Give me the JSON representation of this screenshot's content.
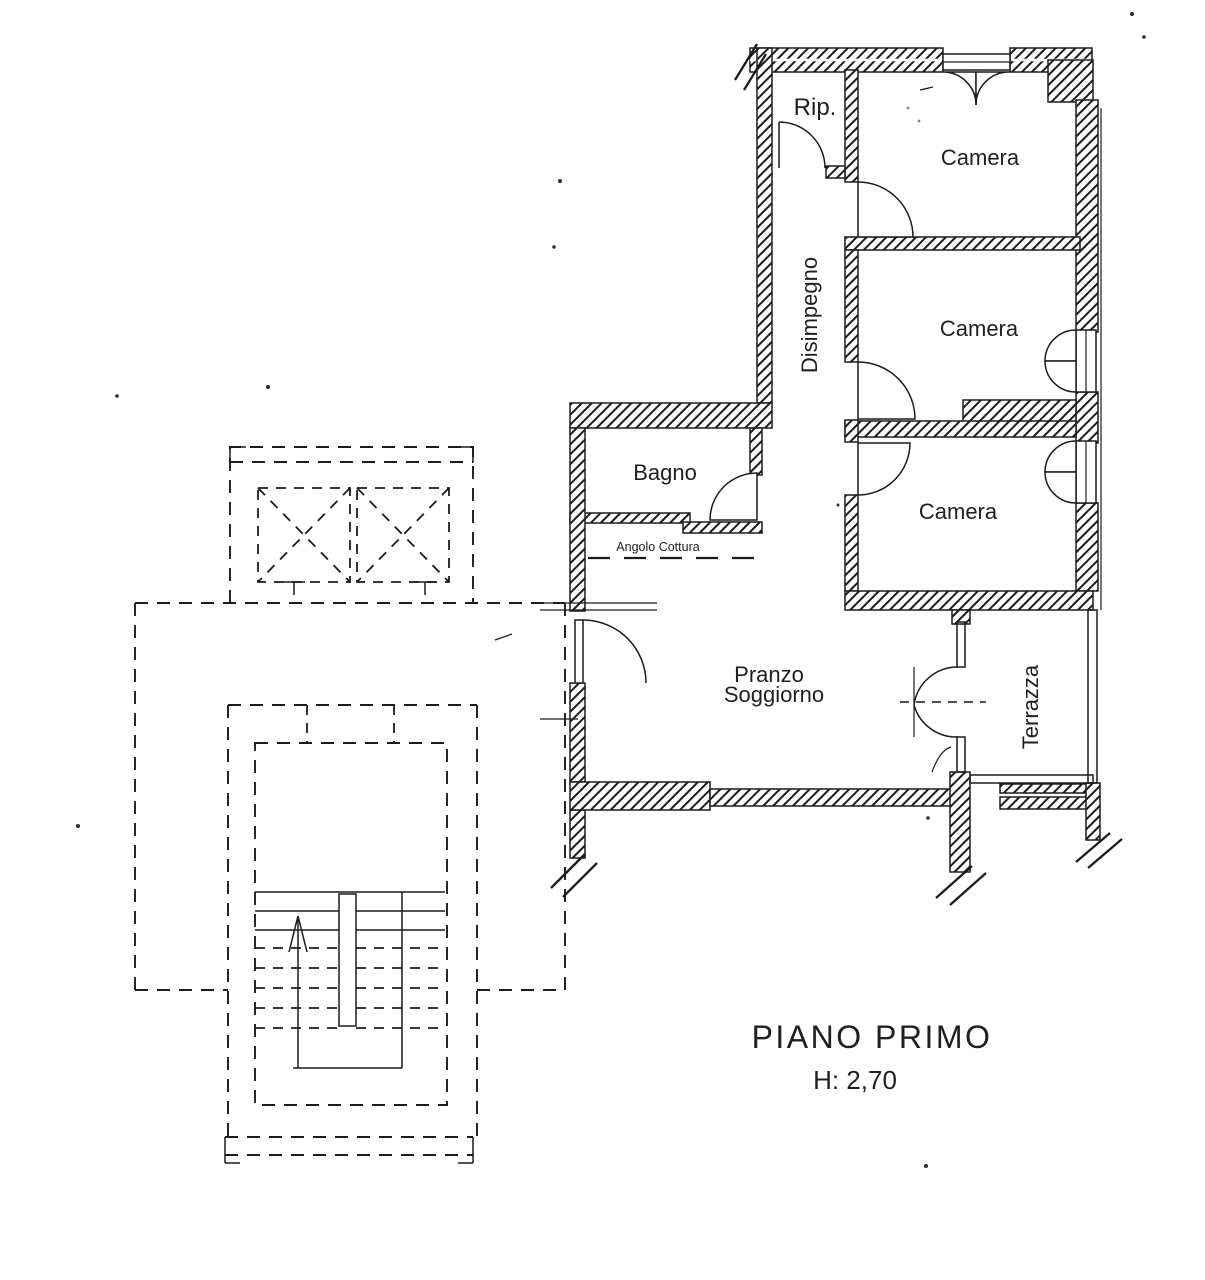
{
  "plan": {
    "title": "PIANO PRIMO",
    "height_label": "H: 2,70",
    "rooms": {
      "rip": "Rip.",
      "camera_top": "Camera",
      "camera_middle": "Camera",
      "camera_bottom": "Camera",
      "disimpegno": "Disimpegno",
      "bagno": "Bagno",
      "angolo_cottura": "Angolo Cottura",
      "pranzo_line1": "Pranzo",
      "pranzo_line2": "Soggiorno",
      "terrazza": "Terrazza"
    },
    "colors": {
      "ink": "#1c1c1c",
      "paper": "#ffffff"
    }
  }
}
